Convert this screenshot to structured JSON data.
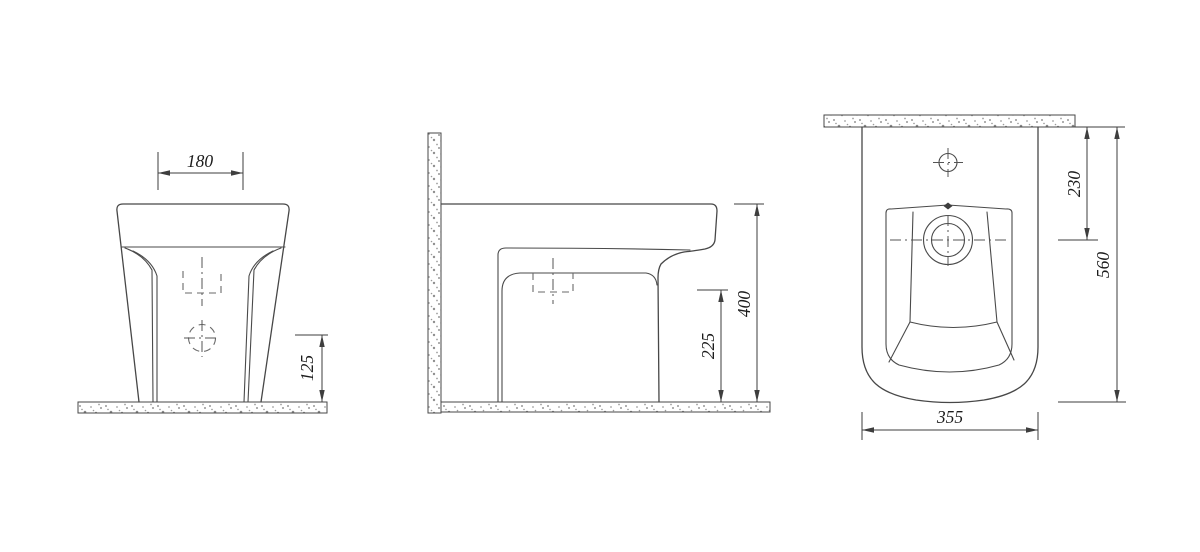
{
  "dimensions": {
    "front_top_width": "180",
    "front_drain_height": "125",
    "side_drain_height": "225",
    "side_total_height": "400",
    "plan_drain_from_wall": "230",
    "plan_total_depth": "560",
    "plan_width": "355"
  },
  "colors": {
    "background": "#ffffff",
    "line": "#474747",
    "dimension_line": "#3e3e3e",
    "text": "#1c1c1c",
    "speckle": "#8f8f8f"
  }
}
